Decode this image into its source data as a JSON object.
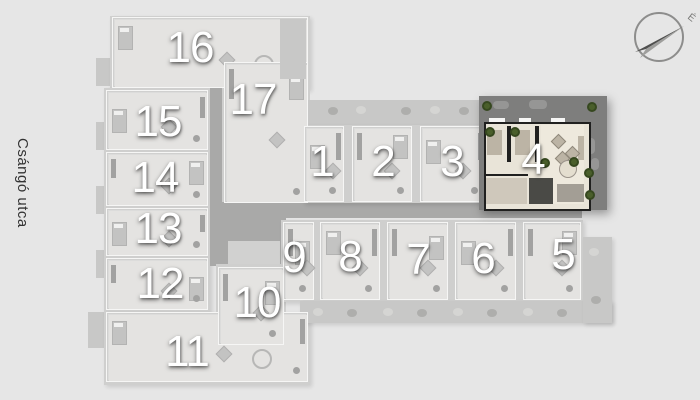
{
  "street": {
    "label": "Csángó utca"
  },
  "compass": {
    "north_label": "É"
  },
  "colors": {
    "background": "#e6e6e6",
    "base": "#cfcfce",
    "unit_fill": "#dcdcdb",
    "unit_inner": "#e4e3e1",
    "wall_white": "#f6f6f5",
    "balcony": "#c8c8c7",
    "corridor": "#a9a9a8",
    "core_dark": "#9c9c9b",
    "core_light": "#d1d1d0",
    "furn_mid": "#c3c3c2",
    "furn_dark": "#a2a2a1",
    "hl_terrace": "#7e7e7d",
    "cream": "#e9e4d8",
    "cream_light": "#eee9dd",
    "cream_furn": "#bcb4a5",
    "wall_dark": "#20201f",
    "bath_dark": "#4a4a46",
    "hall_gray": "#cfc8bb",
    "kitchen_gray": "#a39e95",
    "tree": "#4a5f2b",
    "tree_dark": "#36481f",
    "bush": "#aeaeac",
    "bush_light": "#d5d5d3",
    "number": "#ffffff"
  },
  "blocks": [
    {
      "name": "balcony-tab-1",
      "r": [
        96,
        58,
        14,
        28
      ],
      "c": "balcony"
    },
    {
      "name": "balcony-tab-2",
      "r": [
        96,
        122,
        14,
        28
      ],
      "c": "balcony"
    },
    {
      "name": "balcony-tab-3",
      "r": [
        96,
        186,
        14,
        28
      ],
      "c": "balcony"
    },
    {
      "name": "balcony-tab-4",
      "r": [
        96,
        250,
        14,
        28
      ],
      "c": "balcony"
    },
    {
      "name": "balcony-tab-5",
      "r": [
        88,
        312,
        16,
        36
      ],
      "c": "balcony"
    },
    {
      "name": "wing-north",
      "r": [
        110,
        16,
        200,
        74
      ],
      "c": "base",
      "sh": true
    },
    {
      "name": "wing-west-column",
      "r": [
        104,
        88,
        106,
        226
      ],
      "c": "base",
      "sh": true
    },
    {
      "name": "wing-south",
      "r": [
        104,
        312,
        206,
        73
      ],
      "c": "base",
      "sh": true
    },
    {
      "name": "wing-center-north",
      "r": [
        216,
        58,
        94,
        148
      ],
      "c": "base"
    },
    {
      "name": "corridor-vertical",
      "r": [
        210,
        84,
        12,
        120
      ],
      "c": "corridor"
    },
    {
      "name": "stair-core",
      "r": [
        226,
        144,
        56,
        30
      ],
      "c": "core_dark"
    },
    {
      "name": "corridor-main",
      "r": [
        210,
        202,
        372,
        16
      ],
      "c": "corridor"
    },
    {
      "name": "atrium",
      "r": [
        210,
        218,
        76,
        48
      ],
      "c": "corridor"
    },
    {
      "name": "elevator-core",
      "r": [
        228,
        241,
        52,
        25
      ],
      "c": "core_light"
    },
    {
      "name": "wing-center-south",
      "r": [
        216,
        264,
        70,
        84
      ],
      "c": "base"
    },
    {
      "name": "balcony-row-top",
      "r": [
        303,
        100,
        184,
        25
      ],
      "c": "balcony"
    },
    {
      "name": "wing-row-top",
      "r": [
        303,
        125,
        184,
        78
      ],
      "c": "base",
      "sh": true
    },
    {
      "name": "wing-row-bottom",
      "r": [
        281,
        220,
        302,
        82
      ],
      "c": "base",
      "sh": true
    },
    {
      "name": "terrace-row-bottom",
      "r": [
        300,
        301,
        312,
        22
      ],
      "c": "balcony",
      "sh": true
    },
    {
      "name": "terrace-east",
      "r": [
        583,
        237,
        29,
        86
      ],
      "c": "balcony",
      "sh": true
    },
    {
      "name": "terrace-16",
      "r": [
        280,
        19,
        26,
        60
      ],
      "c": "balcony",
      "z": 7
    }
  ],
  "units": [
    {
      "label": "16",
      "x": 112,
      "y": 17,
      "w": 196,
      "h": 71,
      "nx": 190,
      "ny": 48
    },
    {
      "label": "17",
      "x": 224,
      "y": 62,
      "w": 84,
      "h": 141,
      "nx": 253,
      "ny": 100
    },
    {
      "label": "15",
      "x": 106,
      "y": 90,
      "w": 102,
      "h": 60,
      "nx": 158,
      "ny": 122
    },
    {
      "label": "14",
      "x": 106,
      "y": 152,
      "w": 102,
      "h": 54,
      "nx": 155,
      "ny": 178
    },
    {
      "label": "13",
      "x": 106,
      "y": 208,
      "w": 102,
      "h": 48,
      "nx": 158,
      "ny": 229
    },
    {
      "label": "12",
      "x": 106,
      "y": 258,
      "w": 102,
      "h": 52,
      "nx": 160,
      "ny": 284
    },
    {
      "label": "11",
      "x": 106,
      "y": 312,
      "w": 202,
      "h": 70,
      "nx": 187,
      "ny": 352
    },
    {
      "label": "10",
      "x": 218,
      "y": 267,
      "w": 66,
      "h": 78,
      "nx": 257,
      "ny": 303
    },
    {
      "label": "1",
      "x": 304,
      "y": 126,
      "w": 40,
      "h": 76,
      "nx": 322,
      "ny": 162
    },
    {
      "label": "2",
      "x": 352,
      "y": 126,
      "w": 60,
      "h": 76,
      "nx": 383,
      "ny": 162
    },
    {
      "label": "3",
      "x": 420,
      "y": 126,
      "w": 66,
      "h": 76,
      "nx": 452,
      "ny": 162
    },
    {
      "label": "9",
      "x": 283,
      "y": 222,
      "w": 31,
      "h": 78,
      "nx": 294,
      "ny": 258
    },
    {
      "label": "8",
      "x": 320,
      "y": 222,
      "w": 60,
      "h": 78,
      "nx": 350,
      "ny": 257
    },
    {
      "label": "7",
      "x": 387,
      "y": 222,
      "w": 61,
      "h": 78,
      "nx": 418,
      "ny": 260
    },
    {
      "label": "6",
      "x": 455,
      "y": 222,
      "w": 61,
      "h": 78,
      "nx": 483,
      "ny": 259
    },
    {
      "label": "5",
      "x": 523,
      "y": 222,
      "w": 58,
      "h": 78,
      "nx": 563,
      "ny": 255
    }
  ],
  "highlight": {
    "label": "4",
    "origin": [
      479,
      96
    ],
    "size": [
      128,
      114
    ],
    "number_pos": [
      533,
      160
    ],
    "rooms": [
      {
        "n": "apartment-floor",
        "r": [
          5,
          26,
          103,
          85
        ],
        "c": "cream",
        "wall": true
      },
      {
        "n": "living-room-floor",
        "r": [
          62,
          29,
          43,
          79
        ],
        "c": "cream_light"
      },
      {
        "n": "hallway",
        "r": [
          7,
          82,
          41,
          26
        ],
        "c": "hall_gray"
      },
      {
        "n": "bathroom",
        "r": [
          50,
          82,
          24,
          26
        ],
        "c": "bath_dark"
      },
      {
        "n": "kitchen",
        "r": [
          78,
          88,
          27,
          18
        ],
        "c": "kitchen_gray"
      },
      {
        "n": "closet-1",
        "r": [
          28,
          30,
          4,
          36
        ],
        "c": "wall_dark"
      },
      {
        "n": "closet-2",
        "r": [
          56,
          30,
          4,
          36
        ],
        "c": "wall_dark"
      },
      {
        "n": "bed-1",
        "r": [
          8,
          34,
          15,
          25
        ],
        "c": "cream_furn"
      },
      {
        "n": "bed-2",
        "r": [
          36,
          34,
          15,
          25
        ],
        "c": "cream_furn"
      },
      {
        "n": "wall-mid",
        "r": [
          5,
          78,
          44,
          2
        ],
        "c": "wall_dark"
      },
      {
        "n": "couch",
        "r": [
          99,
          40,
          6,
          24
        ],
        "c": "cream_furn"
      },
      {
        "n": "balcony-tick-1",
        "r": [
          10,
          22,
          16,
          4
        ],
        "c": "wall_white"
      },
      {
        "n": "balcony-tick-2",
        "r": [
          40,
          22,
          12,
          4
        ],
        "c": "wall_white"
      },
      {
        "n": "balcony-tick-3",
        "r": [
          72,
          22,
          14,
          4
        ],
        "c": "wall_white"
      }
    ],
    "diamonds": [
      [
        74,
        40
      ],
      [
        88,
        52
      ],
      [
        78,
        57
      ]
    ],
    "table": {
      "cx": 88,
      "cy": 72,
      "r": 8
    },
    "terrace_items": [
      [
        14,
        5,
        16,
        8
      ],
      [
        50,
        4,
        18,
        9
      ],
      [
        108,
        42,
        8,
        16
      ],
      [
        112,
        62,
        8,
        12
      ]
    ],
    "trees": [
      [
        8,
        10
      ],
      [
        113,
        11
      ],
      [
        11,
        36
      ],
      [
        36,
        36
      ],
      [
        66,
        67
      ],
      [
        95,
        66
      ],
      [
        110,
        77
      ],
      [
        111,
        99
      ]
    ]
  },
  "bushes": [
    [
      333,
      111
    ],
    [
      361,
      110
    ],
    [
      406,
      111
    ],
    [
      435,
      110
    ],
    [
      464,
      111
    ],
    [
      292,
      34
    ],
    [
      294,
      62
    ],
    [
      318,
      312
    ],
    [
      352,
      313
    ],
    [
      388,
      312
    ],
    [
      422,
      313
    ],
    [
      458,
      312
    ],
    [
      492,
      313
    ],
    [
      528,
      312
    ],
    [
      562,
      313
    ],
    [
      594,
      252
    ],
    [
      596,
      300
    ]
  ]
}
